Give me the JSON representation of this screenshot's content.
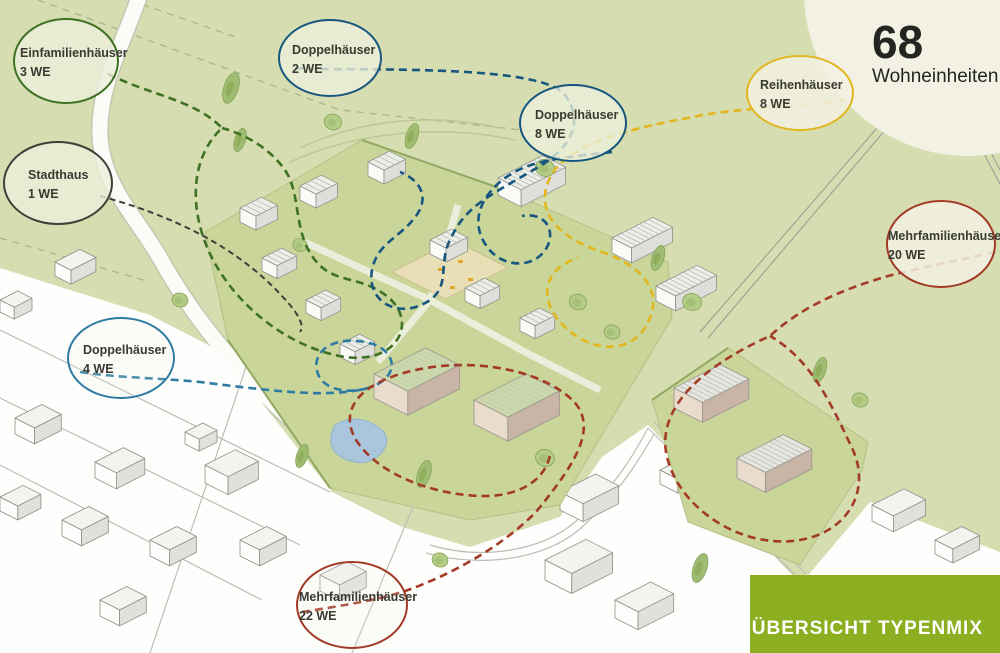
{
  "canvas": {
    "background_green": "#d5ddb1",
    "cream_circle": "#f2f1e3",
    "site_green": "#cad59a"
  },
  "total_block": {
    "number": "68",
    "label": "Wohneinheiten"
  },
  "banner": {
    "text": "ÜBERSICHT TYPENMIX",
    "color": "#8cae21"
  },
  "legend_bubbles": [
    {
      "id": "einfamilienhaeuser",
      "name": "Einfamilienhäuser",
      "units": "3 WE",
      "color": "#3f7122"
    },
    {
      "id": "stadthaus",
      "name": "Stadthaus",
      "units": "1 WE",
      "color": "#3f3f38"
    },
    {
      "id": "doppelhaeuser-2",
      "name": "Doppelhäuser",
      "units": "2 WE",
      "color": "#17567f"
    },
    {
      "id": "doppelhaeuser-8",
      "name": "Doppelhäuser",
      "units": "8 WE",
      "color": "#17567f"
    },
    {
      "id": "doppelhaeuser-4",
      "name": "Doppelhäuser",
      "units": "4 WE",
      "color": "#2f7ba3"
    },
    {
      "id": "reihenhaeuser",
      "name": "Reihenhäuser",
      "units": "8 WE",
      "color": "#e2b71e"
    },
    {
      "id": "mehrfamilienhaeuser-20",
      "name": "Mehrfamilienhäuser",
      "units": "20 WE",
      "color": "#a23a26"
    },
    {
      "id": "mehrfamilienhaeuser-22",
      "name": "Mehrfamilienhäuser",
      "units": "22 WE",
      "color": "#a23a26"
    }
  ]
}
